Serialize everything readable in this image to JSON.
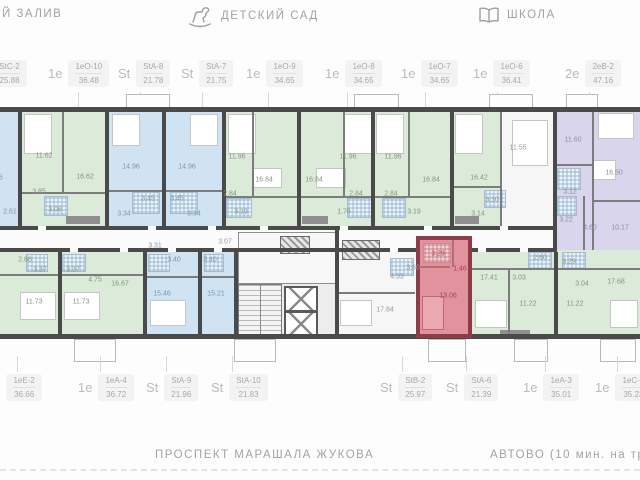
{
  "top_bar": {
    "left": "Й ЗАЛИВ",
    "kindergarten": "ДЕТСКИЙ САД",
    "school": "ШКОЛА"
  },
  "bottom_bar": {
    "street": "ПРОСПЕКТ МАРАШАЛА ЖУКОВА",
    "metro": "АВТОВО (10 мин. на трансп"
  },
  "selected_unit": {
    "code": "StA-6",
    "area": "21.39"
  },
  "labels_top": [
    {
      "type": "St",
      "code": "StC-2",
      "area": "25.88"
    },
    {
      "type": "1е",
      "code": "1еО-10",
      "area": "36.48"
    },
    {
      "type": "St",
      "code": "StA-8",
      "area": "21.78"
    },
    {
      "type": "St",
      "code": "StA-7",
      "area": "21.75"
    },
    {
      "type": "1е",
      "code": "1еО-9",
      "area": "34.65"
    },
    {
      "type": "1е",
      "code": "1еО-8",
      "area": "34.65"
    },
    {
      "type": "1е",
      "code": "1еО-7",
      "area": "34.65"
    },
    {
      "type": "1е",
      "code": "1еО-6",
      "area": "36.41"
    },
    {
      "type": "2е",
      "code": "2еВ-2",
      "area": "47.16"
    }
  ],
  "labels_bottom": [
    {
      "type": "1е",
      "code": "1еЕ-2",
      "area": "36.66"
    },
    {
      "type": "1е",
      "code": "1еА-4",
      "area": "36.72"
    },
    {
      "type": "St",
      "code": "StA-9",
      "area": "21.96"
    },
    {
      "type": "St",
      "code": "StA-10",
      "area": "21.83"
    },
    {
      "type": "St",
      "code": "StB-2",
      "area": "25.97"
    },
    {
      "type": "St",
      "code": "StA-6",
      "area": "21.39"
    },
    {
      "type": "1е",
      "code": "1еА-3",
      "area": "35.01"
    },
    {
      "type": "1е",
      "code": "1еС-2",
      "area": "35.23"
    }
  ],
  "rooms": {
    "t0a": "15.66",
    "t0b": "2.61",
    "t1a": "11.62",
    "t1b": "16.62",
    "t1c": "3.85",
    "t1d": "3.08",
    "t2a": "14.96",
    "t2b": "3.45",
    "t2c": "3.34",
    "t3a": "14.96",
    "t3b": "3.45",
    "t3c": "3.34",
    "t4a": "11.96",
    "t4b": "16.84",
    "t4c": "2.84",
    "t4d": "3.19",
    "t5a": "11.96",
    "t5b": "16.84",
    "t5c": "2.84",
    "t5d": "1.78",
    "t6a": "11.96",
    "t6b": "16.84",
    "t6c": "2.84",
    "t6d": "3.19",
    "t7a": "16.42",
    "t7b": "11.55",
    "t7c": "3.10",
    "t7d": "3.14",
    "t8a": "11.60",
    "t8b": "16.50",
    "t8c": "3.12",
    "t8d": "3.22",
    "t8e": "4.60",
    "t8f": "10.17",
    "b1a": "2.66",
    "b1b": "3.37",
    "b1c": "11.73",
    "b2a": "3.37",
    "b2b": "11.73",
    "b2c": "4.75",
    "b2d": "16.67",
    "b3a": "3.31",
    "b3b": "3.40",
    "b3c": "15.46",
    "b4a": "3.40",
    "b4b": "15.21",
    "core_a": "3.07",
    "b5a": "17.84",
    "b5b": "4.33",
    "b5c": "3.80",
    "sel_a": "3.29",
    "sel_b": "1.46",
    "sel_c": "13.06",
    "b6a": "17.41",
    "b6b": "3.03",
    "b6c": "2.60",
    "b6d": "11.22",
    "b7a": "3.29",
    "b7b": "3.04",
    "b7c": "17.68",
    "b7d": "11.22"
  },
  "colors": {
    "studio": "#cfe3f2",
    "one_bed": "#dcead9",
    "two_bed": "#d9d5ec",
    "selected_fill": "#e2929d",
    "selected_wall": "#8e3c47",
    "wall": "#4a4a4a"
  }
}
